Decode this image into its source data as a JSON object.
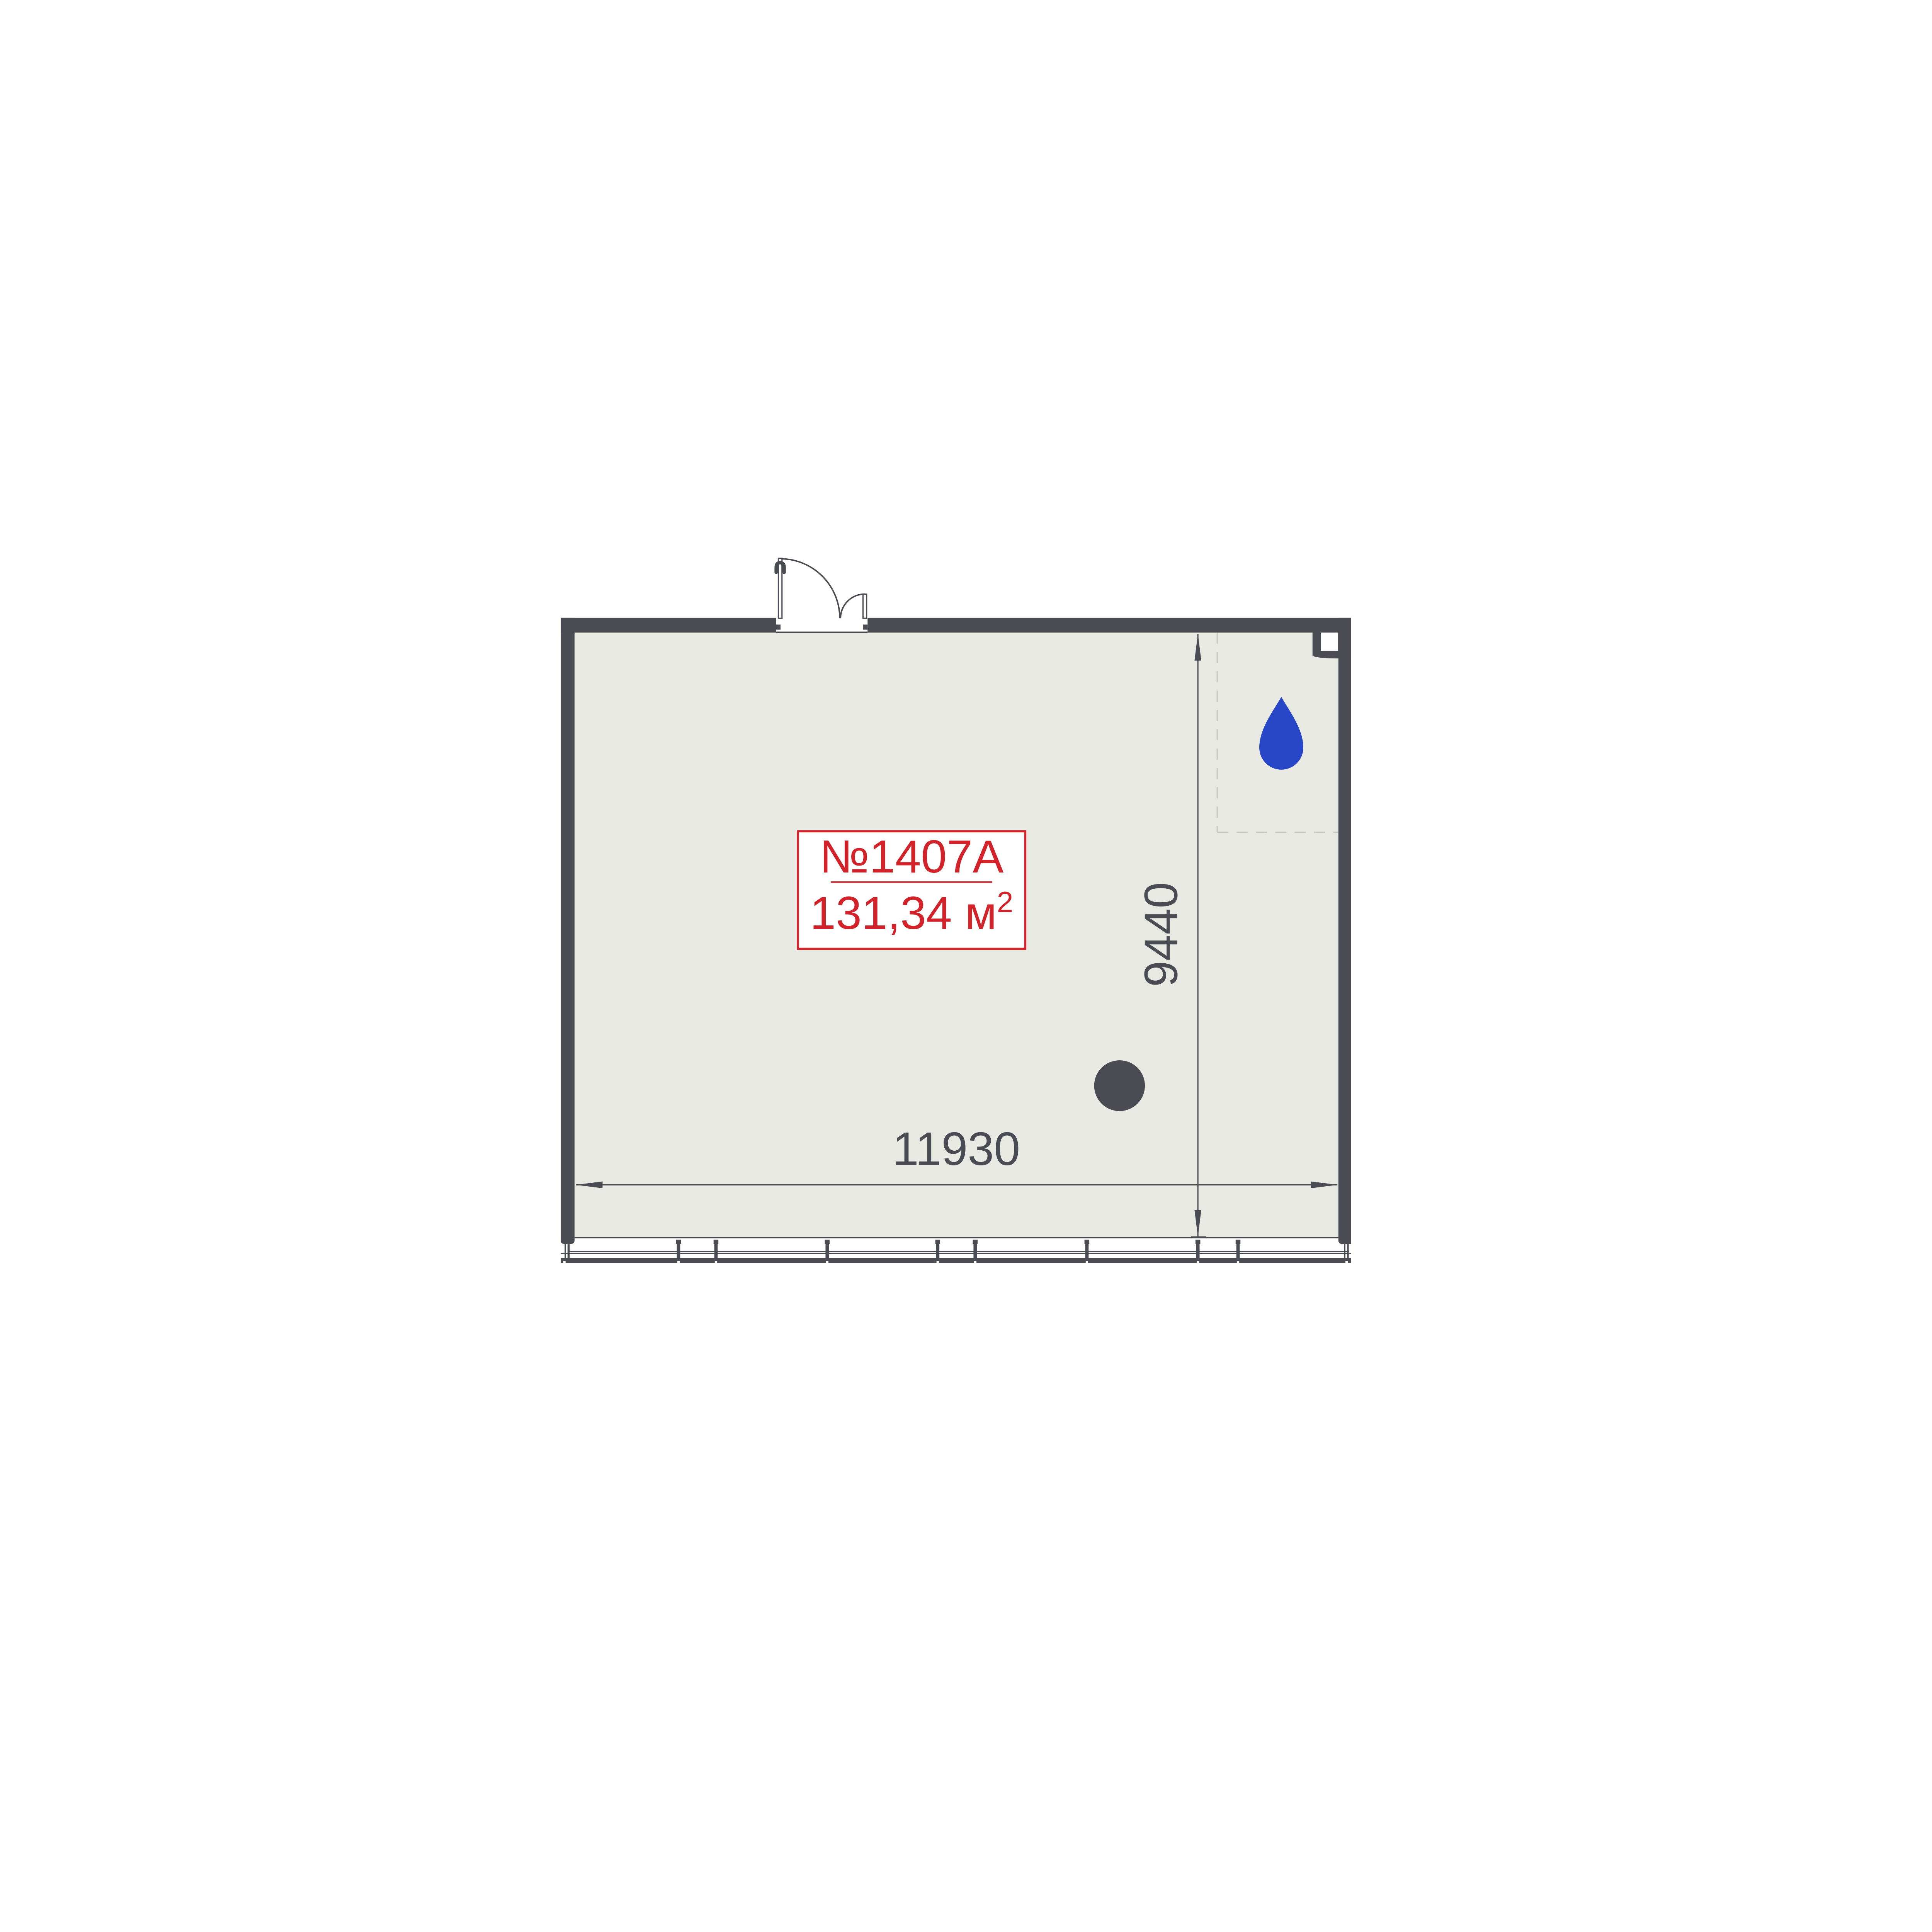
{
  "unit": {
    "number": "№1407A",
    "area_value": "131,34 м",
    "area_exponent": "2",
    "area_full": "131,34 м²"
  },
  "dimensions": {
    "width_mm": "11930",
    "height_mm": "9440"
  },
  "colors": {
    "wall_dark_gray": "#4B4C53",
    "floor_light_gray": "#E8E9E3",
    "label_red": "#D2232A",
    "water_drop_blue": "#2847C8",
    "wet_zone_dash_gray": "#C7C7C4",
    "background": "#FFFFFF"
  },
  "icons": {
    "water_drop": "water-drop-icon",
    "structural_column": "column-circle-icon",
    "entry_door": "double-swing-door-symbol",
    "vent_shaft": "corner-shaft-symbol"
  }
}
